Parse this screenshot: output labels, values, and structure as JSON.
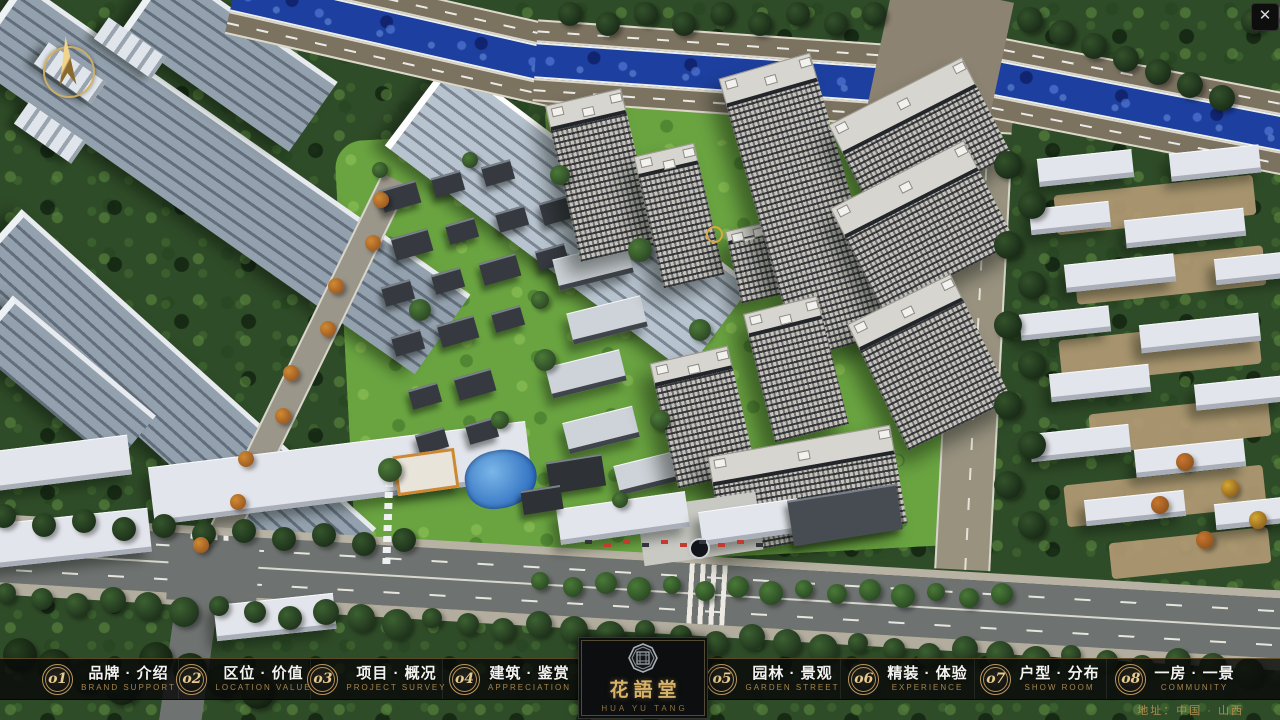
{
  "app": {
    "close_glyph": "✕"
  },
  "menu": {
    "items": [
      {
        "num": "o1",
        "label": "品牌 · 介绍",
        "sub": "BRAND SUPPORT"
      },
      {
        "num": "o2",
        "label": "区位 · 价值",
        "sub": "LOCATION VALUE"
      },
      {
        "num": "o3",
        "label": "项目 · 概况",
        "sub": "PROJECT SURVEY"
      },
      {
        "num": "o4",
        "label": "建筑 · 鉴赏",
        "sub": "APPRECIATION"
      },
      {
        "num": "o5",
        "label": "园林 · 景观",
        "sub": "GARDEN STREET"
      },
      {
        "num": "o6",
        "label": "精装 · 体验",
        "sub": "EXPERIENCE"
      },
      {
        "num": "o7",
        "label": "户型 · 分布",
        "sub": "SHOW ROOM"
      },
      {
        "num": "o8",
        "label": "一房 · 一景",
        "sub": "COMMUNITY"
      }
    ]
  },
  "logo": {
    "title": "花語堂",
    "subtitle": "HUA YU TANG"
  },
  "footer": {
    "address": "地址：中国 · 山西"
  },
  "colors": {
    "gold": "#c7a15c",
    "river": "#1d3f9f",
    "bar": "#0a0c0b"
  }
}
